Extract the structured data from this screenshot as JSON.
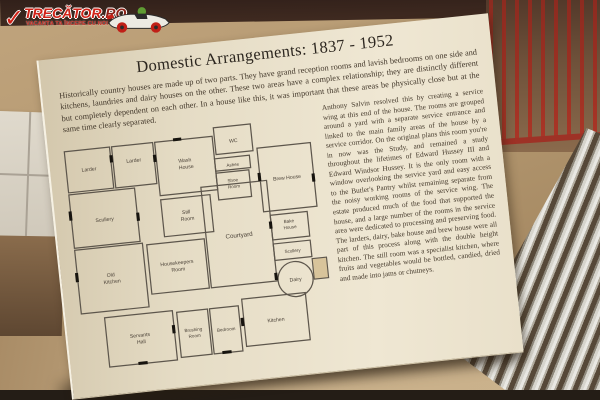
{
  "watermark": {
    "brand_main": "TRECĂTOR",
    "brand_tld": ".RO",
    "tagline": "VACANȚA TA ÎNCEPE CU NOI"
  },
  "board": {
    "title": "Domestic Arrangements: 1837 - 1952",
    "intro": "Historically country houses are made up of two parts. They have grand reception rooms and lavish bedrooms on one side and kitchens, laundries and dairy houses on the other. These two areas have a complex relationship; they are distinctly different but completely dependent on each other. In a house like this, it was important that these areas be physically close but at the same time clearly separated.",
    "body": "Anthony Salvin resolved this by creating a service wing at this end of the house. The rooms are grouped around a yard with a separate service entrance and linked to the main family areas of the house by a service corridor. On the original plans this room you're in now was the Study, and remained a study throughout the lifetimes of Edward Hussey III and Edward Windsor Hussey. It is the only room with a window overlooking the service yard and easy access to the Butler's Pantry whilst remaining separate from the noisy working rooms of the service wing. The estate produced much of the food that supported the house, and a large number of the rooms in the service area were dedicated to processing and preserving food. The larders, dairy, bake house and brew house were all part of this process along with the double height kitchen. The still room was a specialist kitchen, where fruits and vegetables would be bottled, candied, dried and made into jams or chutneys."
  },
  "floor_plan": {
    "rooms": [
      {
        "label": "Larder",
        "lines": [
          "Larder"
        ]
      },
      {
        "label": "Larder",
        "lines": [
          "Larder"
        ]
      },
      {
        "label": "Wash House",
        "lines": [
          "Wash",
          "House"
        ]
      },
      {
        "label": "Scullery",
        "lines": [
          "Scullery"
        ]
      },
      {
        "label": "Still Room",
        "lines": [
          "Still",
          "Room"
        ]
      },
      {
        "label": "Old Kitchen",
        "lines": [
          "Old",
          "Kitchen"
        ]
      },
      {
        "label": "Housekeepers Room",
        "lines": [
          "Housekeepers",
          "Room"
        ]
      },
      {
        "label": "Courtyard",
        "lines": [
          "Courtyard"
        ]
      },
      {
        "label": "Servants Hall",
        "lines": [
          "Servants",
          "Hall"
        ]
      },
      {
        "label": "Brushing Room",
        "lines": [
          "Brushing",
          "Room"
        ]
      },
      {
        "label": "Bedroom",
        "lines": [
          "Bedroom"
        ]
      },
      {
        "label": "Kitchen",
        "lines": [
          "Kitchen"
        ]
      },
      {
        "label": "WC",
        "lines": [
          "WC"
        ]
      },
      {
        "label": "Ashes",
        "lines": [
          "Ashes"
        ]
      },
      {
        "label": "Shoe Room",
        "lines": [
          "Shoe",
          "Room"
        ]
      },
      {
        "label": "Brew House",
        "lines": [
          "Brew House"
        ]
      },
      {
        "label": "Bake House",
        "lines": [
          "Bake",
          "House"
        ]
      },
      {
        "label": "Scullery",
        "lines": [
          "Scullery"
        ]
      },
      {
        "label": "Dairy",
        "lines": [
          "Dairy"
        ]
      }
    ]
  },
  "palette": {
    "wall_tan": "#b79a75",
    "top_band": "#3a241e",
    "board_cream": "#eae1cc",
    "rack_red": "#a83326",
    "steel_light": "#d8d6d0",
    "steel_dark": "#584a3a",
    "counter_tan": "#c3a983",
    "text_dark": "#3c3328",
    "logo_red": "#d02318"
  }
}
